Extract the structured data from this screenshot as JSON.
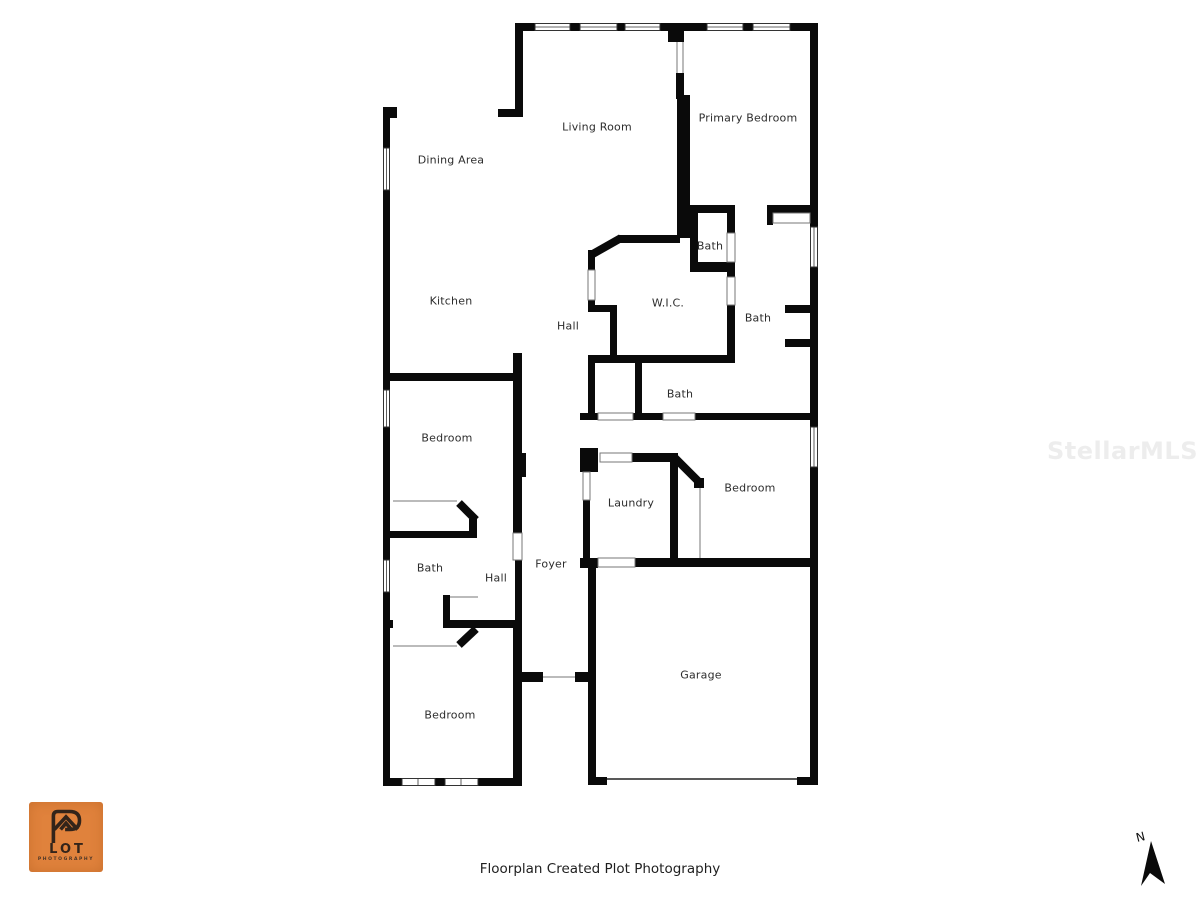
{
  "page": {
    "background": "#ffffff"
  },
  "rooms": {
    "living_room": "Living Room",
    "primary_bedroom": "Primary Bedroom",
    "dining_area": "Dining Area",
    "kitchen": "Kitchen",
    "hall_upper": "Hall",
    "wic": "W.I.C.",
    "bath_wc": "Bath",
    "bath_primary": "Bath",
    "bath_middle": "Bath",
    "bedroom_upper_left": "Bedroom",
    "bedroom_right": "Bedroom",
    "laundry": "Laundry",
    "bath_left": "Bath",
    "hall_lower": "Hall",
    "foyer": "Foyer",
    "garage": "Garage",
    "bedroom_lower_left": "Bedroom"
  },
  "footer": {
    "text": "Floorplan Created Plot Photography"
  },
  "watermark": {
    "text": "StellarMLS",
    "color": "#ededed"
  },
  "compass": {
    "label": "N"
  },
  "logo": {
    "word": "LOT",
    "sub": "PHOTOGRAPHY",
    "bg_color": "#e0823c",
    "fg_color": "#33241a"
  },
  "colors": {
    "wall": "#0a0a0a",
    "thin_line": "#777777",
    "label_text": "#2d2d2d"
  }
}
